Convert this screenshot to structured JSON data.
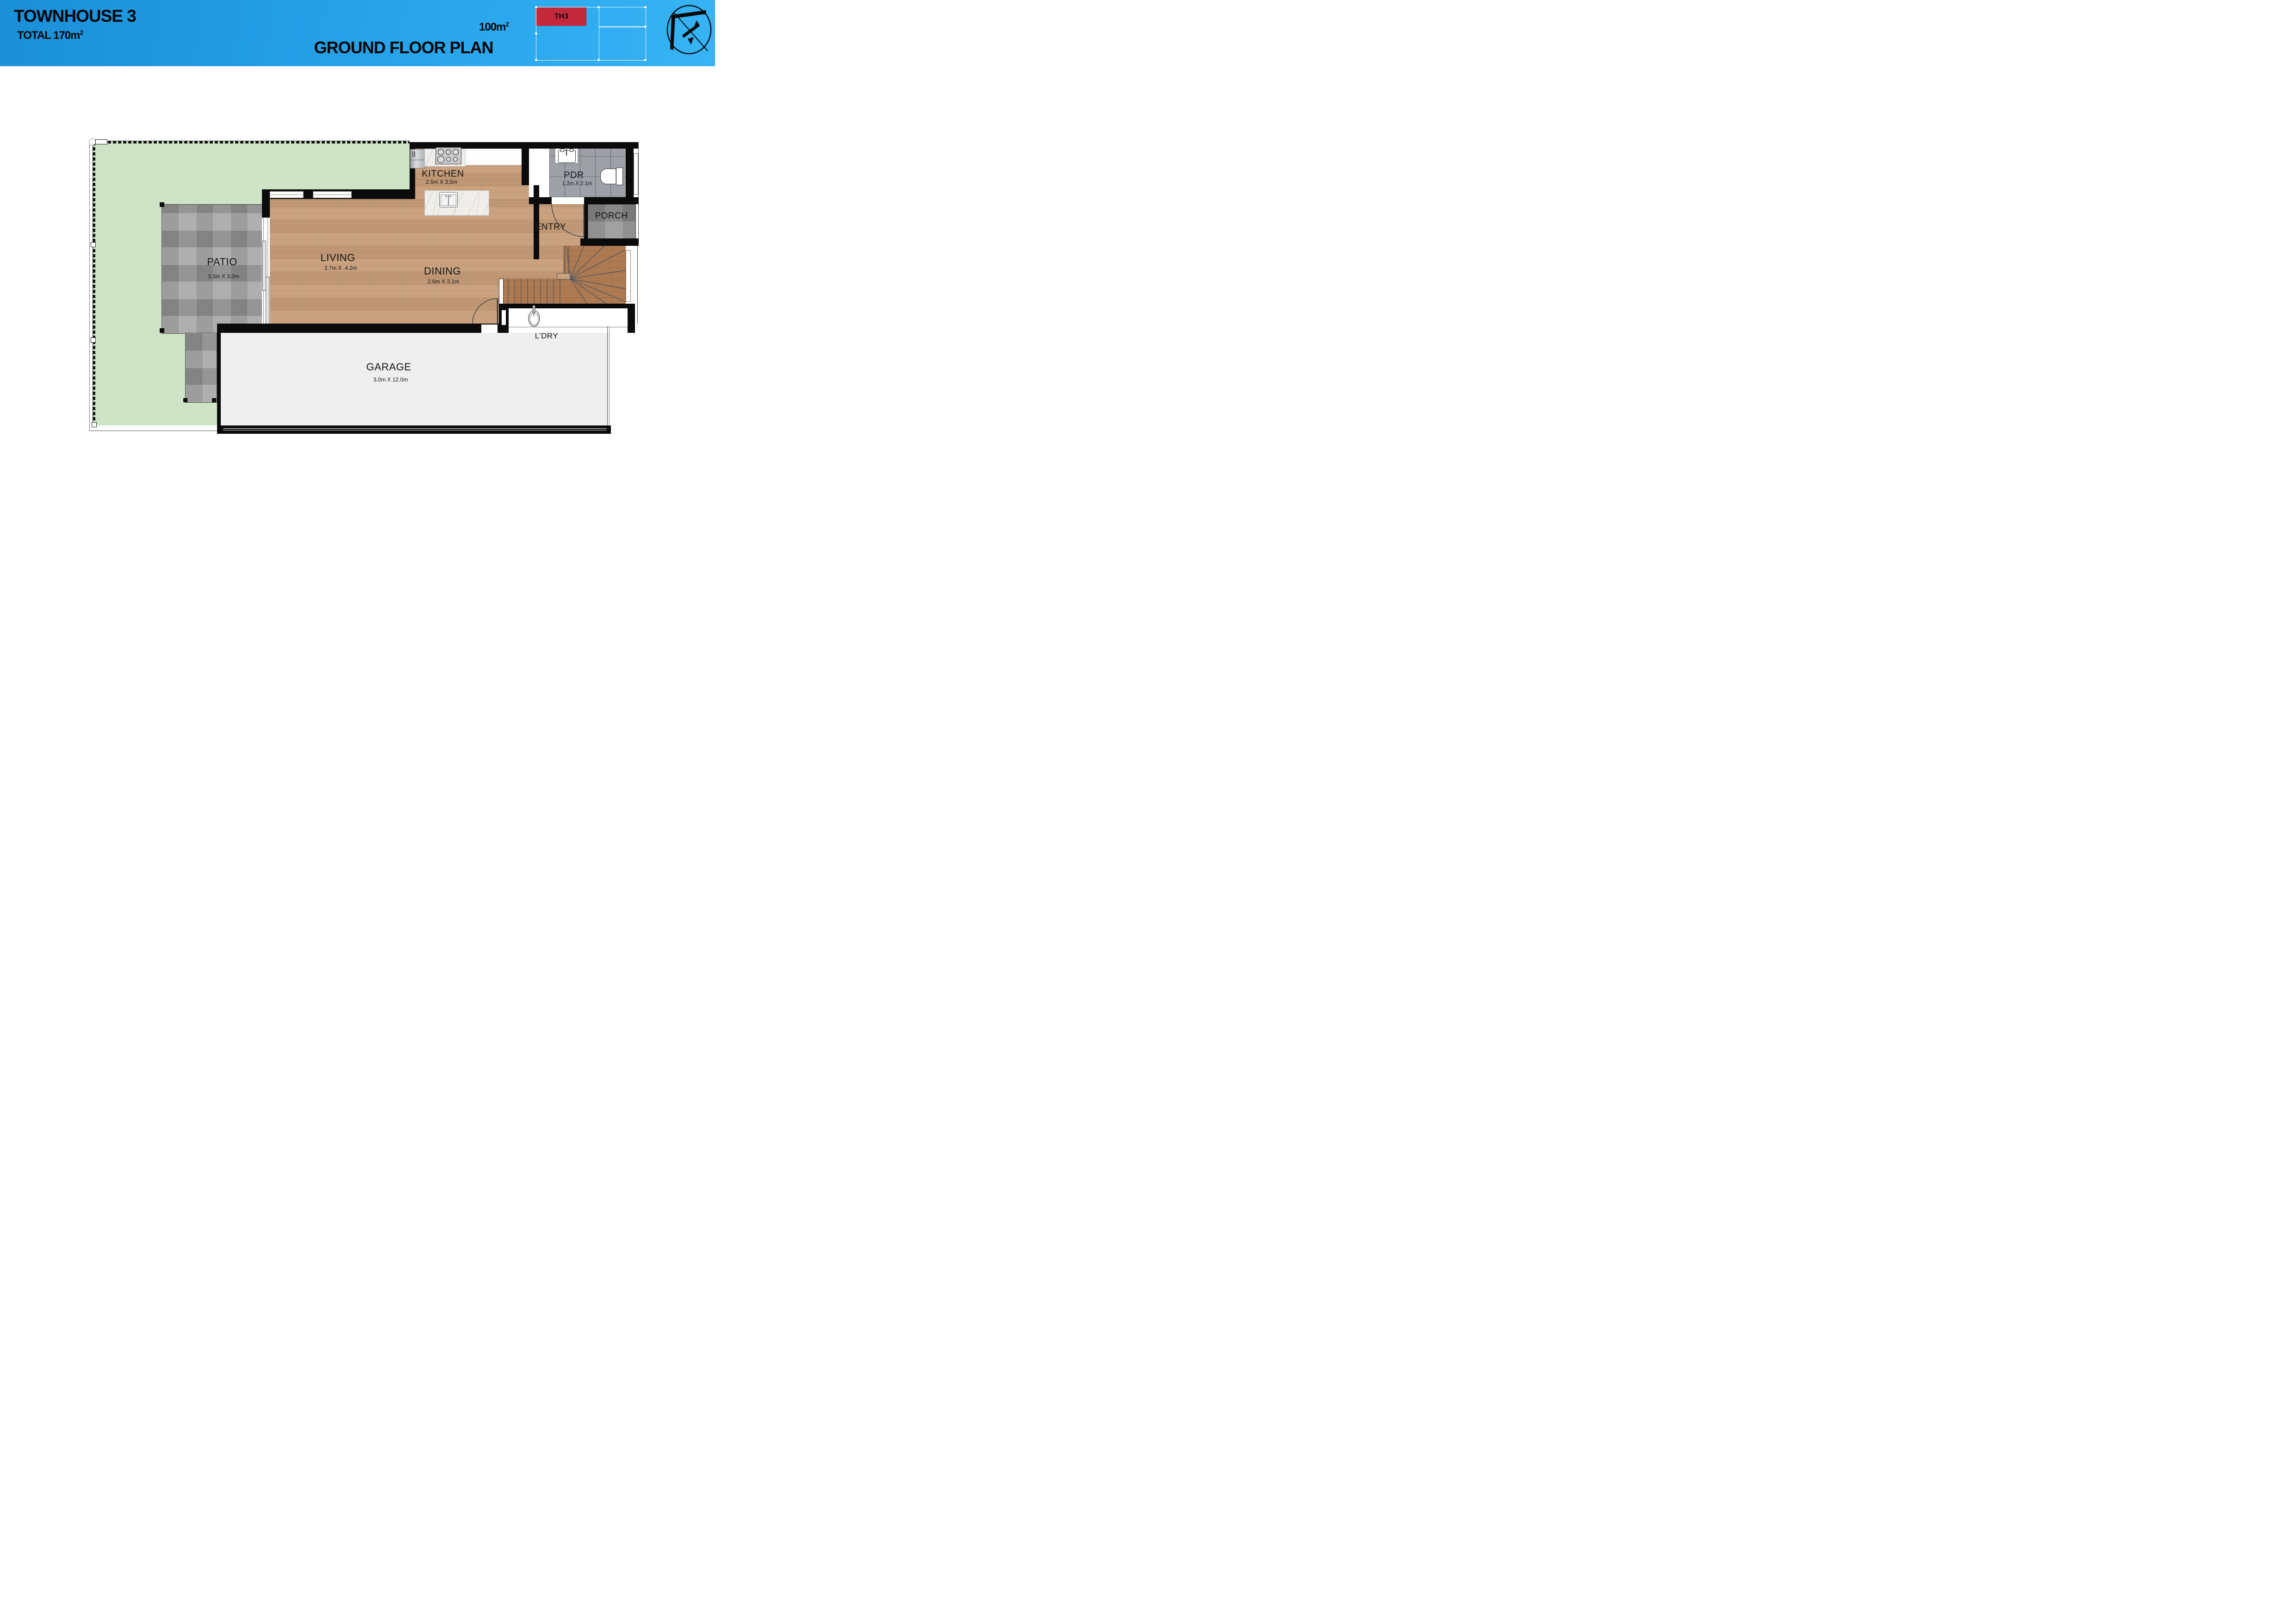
{
  "header": {
    "title": "TOWNHOUSE 3",
    "total_label": "TOTAL 170m",
    "total_sup": "2",
    "area_value": "100m",
    "area_sup": "2",
    "plan_title": "GROUND FLOOR PLAN",
    "badge": "TH3",
    "badge_color": "#c4293b",
    "header_blue_left": "#1a8fd8",
    "header_blue_right": "#36b4f5",
    "logo_icon": "north-arrow-compass-logo"
  },
  "rooms": {
    "kitchen": {
      "name": "KITCHEN",
      "dims": "2.5m X 3.5m"
    },
    "pdr": {
      "name": "PDR",
      "dims": "1.2m X 2.1m"
    },
    "porch": {
      "name": "PORCH"
    },
    "entry": {
      "name": "ENTRY"
    },
    "living": {
      "name": "LIVING",
      "dims": "3.7m X .4.2m"
    },
    "dining": {
      "name": "DINING",
      "dims": "2.6m X 3.1m"
    },
    "patio": {
      "name": "PATIO",
      "dims": "3.3m X 3.0m"
    },
    "ldry": {
      "name": "L’DRY"
    },
    "garage": {
      "name": "GARAGE",
      "dims": "3.0m X 12.0m"
    }
  },
  "palette": {
    "lawn": "#cfe4c7",
    "wood": "#c79d79",
    "wood_dark": "#ad7a52",
    "stone": "#9e9e9e",
    "pdr_tile": "#9da0a6",
    "garage_floor": "#efefef",
    "wall": "#0b0b0b"
  }
}
